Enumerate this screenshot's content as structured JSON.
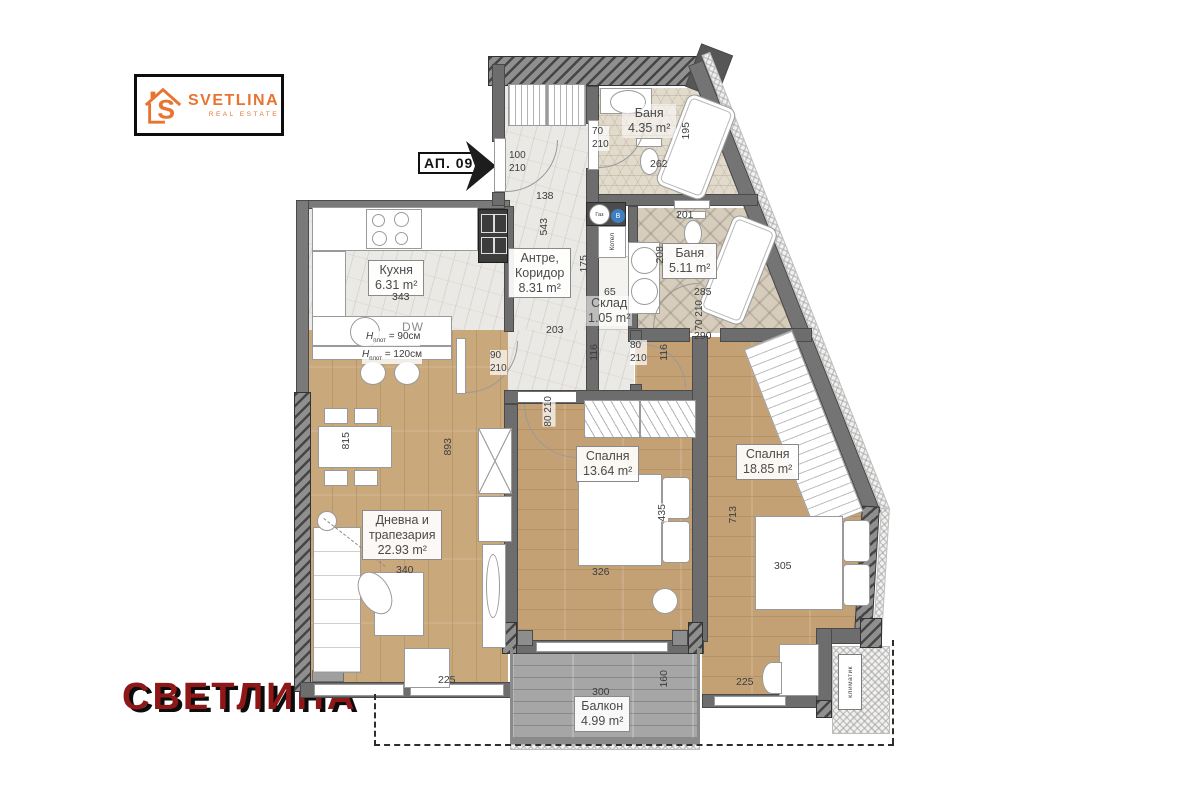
{
  "branding": {
    "logo_text": "SVETLINA",
    "logo_sub": "REAL ESTATE",
    "watermark": "СВЕТЛИНА"
  },
  "unit_label": "АП. 09",
  "rooms": {
    "kitchen": {
      "name": "Кухня",
      "area": "6.31 m²",
      "width": "343"
    },
    "hallway": {
      "name_l1": "Антре,",
      "name_l2": "Коридор",
      "area": "8.31 m²"
    },
    "bath_top": {
      "name": "Баня",
      "area": "4.35 m²"
    },
    "bath_main": {
      "name": "Баня",
      "area": "5.11 m²"
    },
    "storage": {
      "name": "Склад",
      "area": "1.05 m²"
    },
    "bedroom1": {
      "name": "Спалня",
      "area": "13.64 m²"
    },
    "bedroom2": {
      "name": "Спалня",
      "area": "18.85 m²"
    },
    "living": {
      "name_l1": "Дневна и",
      "name_l2": "трапезария",
      "area": "22.93 m²"
    },
    "balcony": {
      "name": "Балкон",
      "area": "4.99 m²"
    }
  },
  "doors": {
    "entrance_w": "100",
    "entrance_h": "210",
    "bath_top_w": "70",
    "bath_top_h": "210",
    "bath_main_w": "70",
    "bath_main_h": "210",
    "living_w": "90",
    "living_h": "210",
    "bedroom1_w": "80",
    "bedroom1_h": "210",
    "bedroom2_w": "80",
    "bedroom2_h": "210"
  },
  "dims": {
    "hall_top": "138",
    "hall_len": "543",
    "hall_mid": "175",
    "hall_low": "203",
    "niche": "65",
    "pass1": "116",
    "pass2": "116",
    "below_bath": "290",
    "bath_top_w": "262",
    "bath_top_d": "195",
    "bath_main_top": "201",
    "bath_main_d": "208",
    "bath_main_w": "285",
    "dining": "815",
    "living_len": "893",
    "living_w": "340",
    "living_low": "225",
    "bed1_w": "326",
    "bed1_d": "435",
    "bed2_len": "713",
    "bed2_w": "305",
    "bed2_low": "225",
    "balcony_w": "300",
    "balcony_d": "160"
  },
  "annotations": {
    "gas": "Газ",
    "water": "В",
    "boiler": "Котел",
    "dw": "DW",
    "h_sym": "H",
    "h_sub": "плот",
    "counter90_val": "= 90см",
    "counter120_val": "= 120см",
    "ac": "климатик"
  }
}
